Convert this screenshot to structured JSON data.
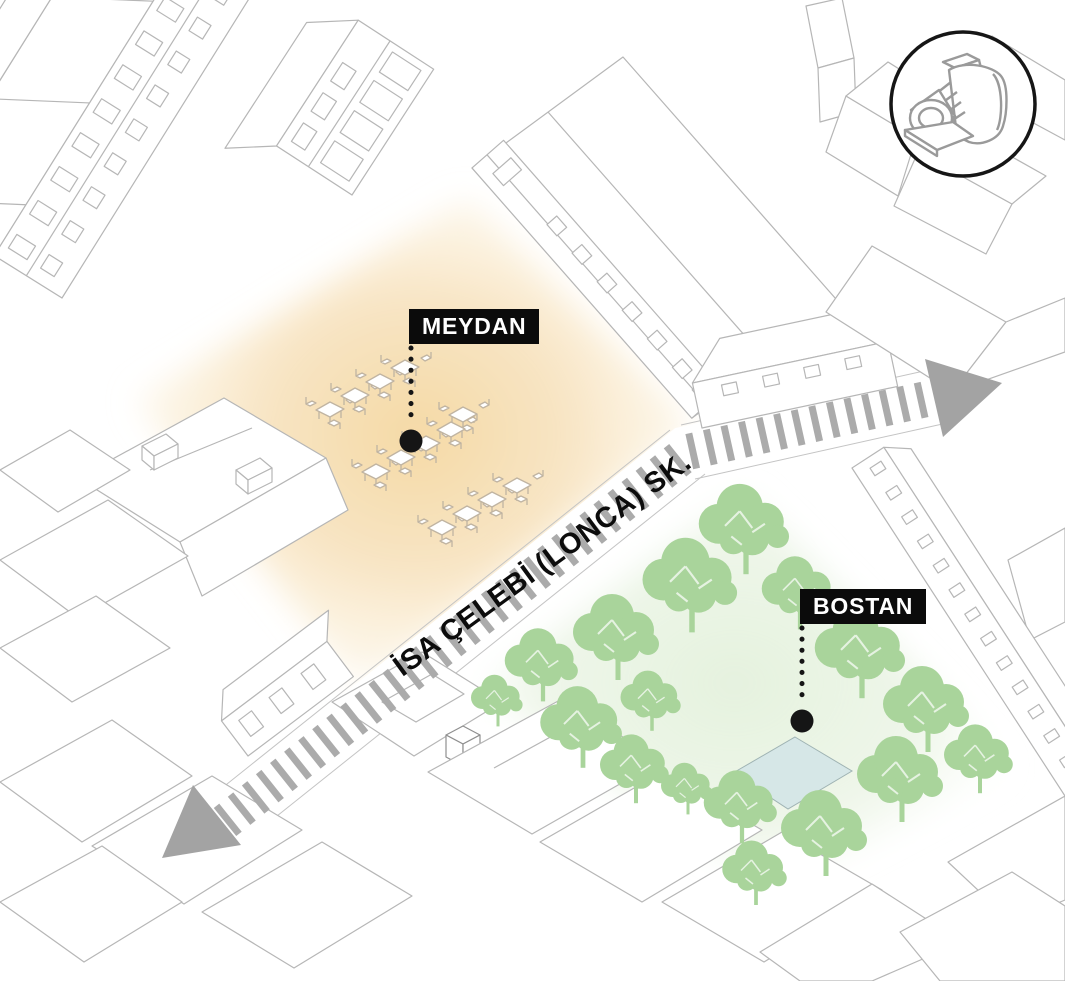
{
  "diagram": {
    "type": "axonometric-site-plan",
    "areas": {
      "meydan": {
        "label": "MEYDAN",
        "fill_center": "#f5d9a6",
        "cafe_tables_count": 13
      },
      "bostan": {
        "label": "BOSTAN",
        "fill_center": "#e2efda",
        "tree_color": "#a9d49b",
        "tree_count": 17,
        "pond_color": "#d6e7e7"
      }
    },
    "street": {
      "label": "İSA ÇELEBİ (LONCA) SK.",
      "stripe_color": "#ababab",
      "arrow_color": "#a3a3a3",
      "direction_arrow_count": 2
    },
    "annotations": {
      "label_bg": "#0b0b0b",
      "label_text_color": "#ffffff",
      "leader_dot_color": "#151515"
    },
    "camera_badge": {
      "icon": "vintage-folding-camera-icon",
      "ring_color": "#161616"
    },
    "linework_color": "#b6b6b6"
  }
}
